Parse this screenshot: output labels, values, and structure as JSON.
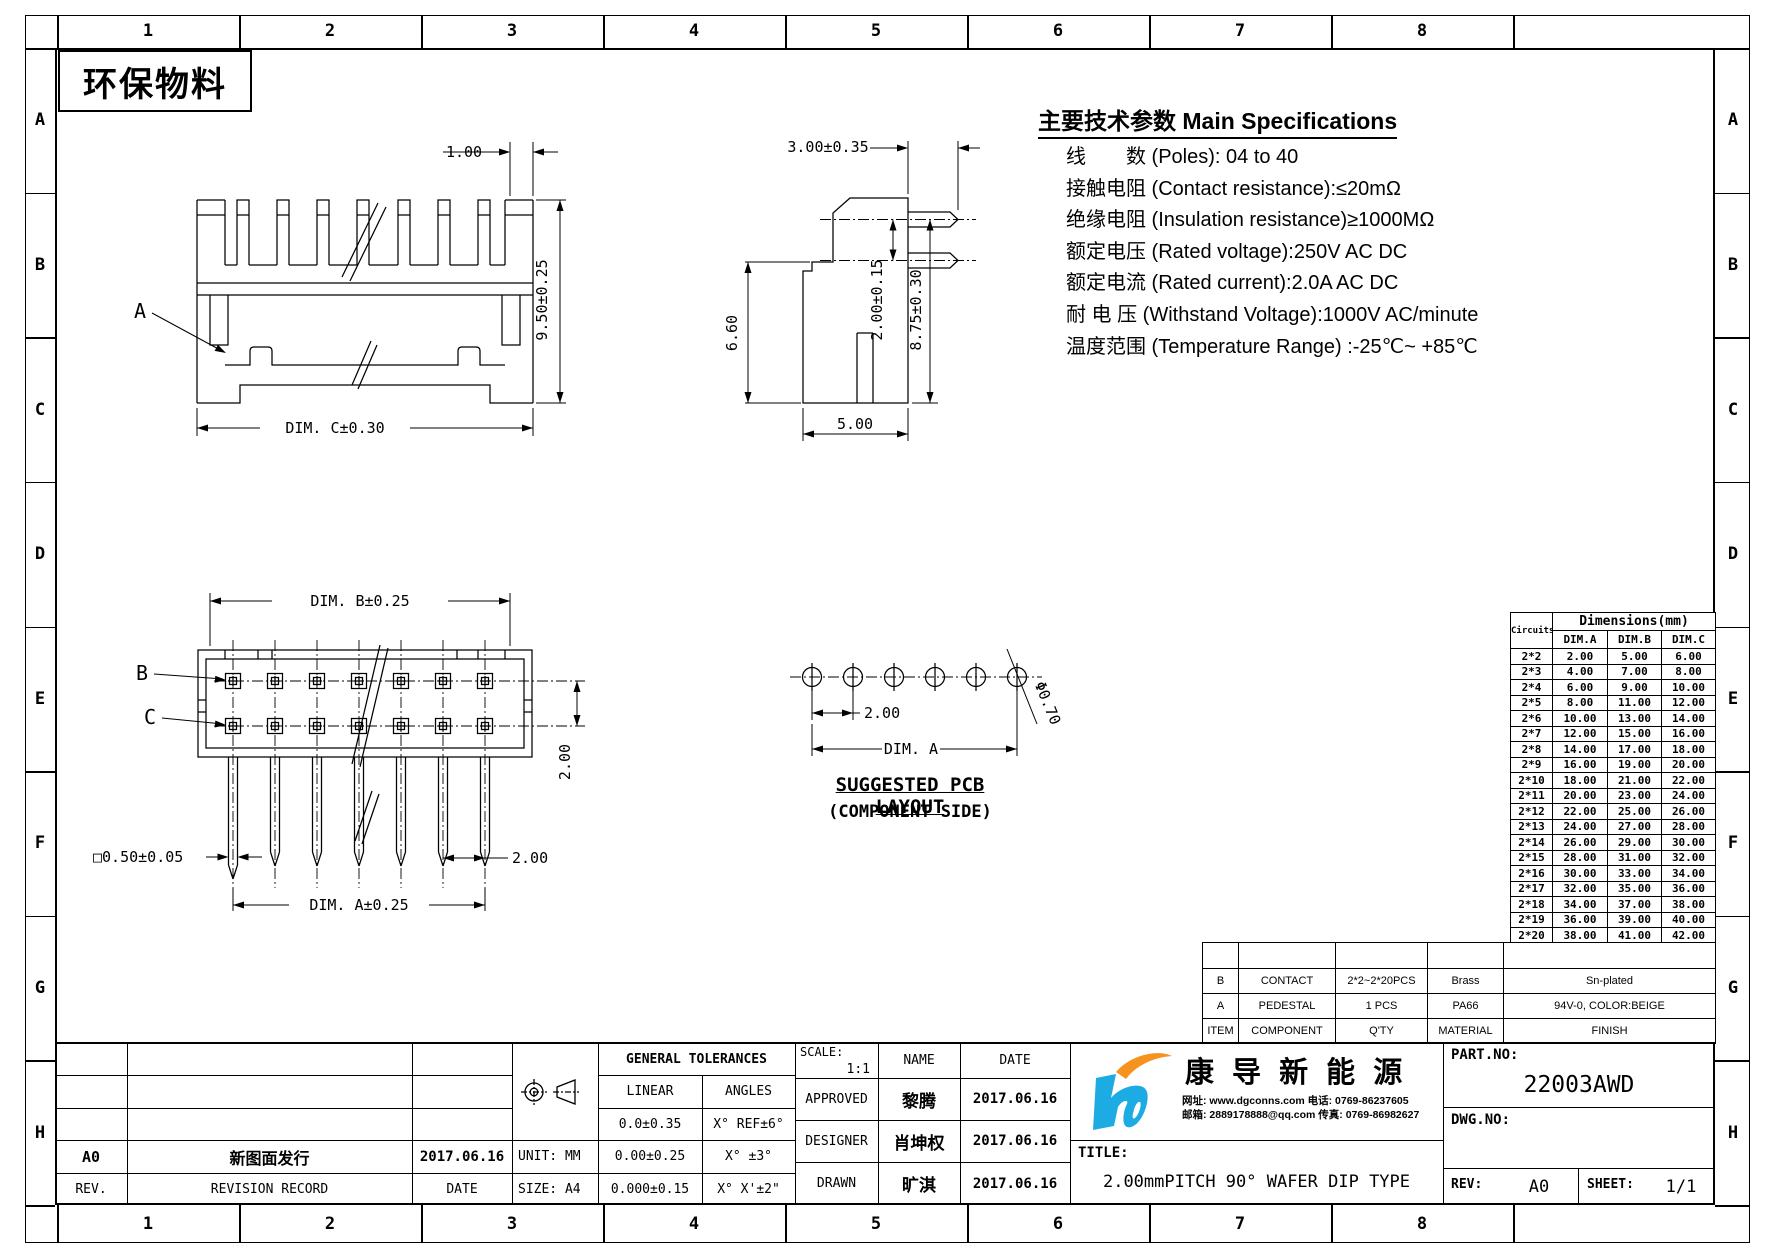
{
  "sheet": {
    "eco_label": "环保物料",
    "zone_columns": [
      "1",
      "2",
      "3",
      "4",
      "5",
      "6",
      "7",
      "8"
    ],
    "zone_rows": [
      "A",
      "B",
      "C",
      "D",
      "E",
      "F",
      "G",
      "H"
    ]
  },
  "specs": {
    "title": "主要技术参数 Main Specifications",
    "lines": [
      "线　　数 (Poles): 04 to 40",
      "接触电阻 (Contact resistance):≤20mΩ",
      "绝缘电阻 (Insulation resistance)≥1000MΩ",
      "额定电压 (Rated voltage):250V AC DC",
      "额定电流 (Rated current):2.0A AC DC",
      "耐 电 压 (Withstand Voltage):1000V AC/minute",
      "温度范围 (Temperature Range) :-25℃~ +85℃"
    ]
  },
  "views": {
    "front_view": {
      "label_a": "A",
      "dim_tooth": "1.00",
      "dim_height": "9.50±0.25",
      "dim_width": "DIM. C±0.30"
    },
    "side_view": {
      "dim_top": "3.00±0.35",
      "dim_front_height": "6.60",
      "dim_bottom": "5.00",
      "dim_pin_spacing": "2.00±0.15",
      "dim_pin_height": "8.75±0.30"
    },
    "top_view": {
      "label_b": "B",
      "label_c": "C",
      "dim_width": "DIM. B±0.25",
      "dim_row_pitch": "2.00",
      "dim_pin_square": "□0.50±0.05",
      "dim_pitch": "2.00",
      "dim_span": "DIM. A±0.25"
    },
    "pcb_layout": {
      "dim_pitch": "2.00",
      "dim_span": "DIM. A",
      "dim_hole": "Φ0.70",
      "title": "SUG GESTED PCB LAYOUT",
      "title_text": "SUGGESTED PCB LAYOUT",
      "subtitle": "(COMPONENT SIDE)"
    }
  },
  "dim_table": {
    "circuits_label": "Circuits",
    "group_header": "Dimensions(mm)",
    "columns": [
      "DIM.A",
      "DIM.B",
      "DIM.C"
    ],
    "rows": [
      [
        "2*2",
        "2.00",
        "5.00",
        "6.00"
      ],
      [
        "2*3",
        "4.00",
        "7.00",
        "8.00"
      ],
      [
        "2*4",
        "6.00",
        "9.00",
        "10.00"
      ],
      [
        "2*5",
        "8.00",
        "11.00",
        "12.00"
      ],
      [
        "2*6",
        "10.00",
        "13.00",
        "14.00"
      ],
      [
        "2*7",
        "12.00",
        "15.00",
        "16.00"
      ],
      [
        "2*8",
        "14.00",
        "17.00",
        "18.00"
      ],
      [
        "2*9",
        "16.00",
        "19.00",
        "20.00"
      ],
      [
        "2*10",
        "18.00",
        "21.00",
        "22.00"
      ],
      [
        "2*11",
        "20.00",
        "23.00",
        "24.00"
      ],
      [
        "2*12",
        "22.00",
        "25.00",
        "26.00"
      ],
      [
        "2*13",
        "24.00",
        "27.00",
        "28.00"
      ],
      [
        "2*14",
        "26.00",
        "29.00",
        "30.00"
      ],
      [
        "2*15",
        "28.00",
        "31.00",
        "32.00"
      ],
      [
        "2*16",
        "30.00",
        "33.00",
        "34.00"
      ],
      [
        "2*17",
        "32.00",
        "35.00",
        "36.00"
      ],
      [
        "2*18",
        "34.00",
        "37.00",
        "38.00"
      ],
      [
        "2*19",
        "36.00",
        "39.00",
        "40.00"
      ],
      [
        "2*20",
        "38.00",
        "41.00",
        "42.00"
      ]
    ]
  },
  "parts_table": {
    "rows": [
      {
        "item": "B",
        "component": "CONTACT",
        "qty": "2*2~2*20PCS",
        "material": "Brass",
        "finish": "Sn-plated"
      },
      {
        "item": "A",
        "component": "PEDESTAL",
        "qty": "1 PCS",
        "material": "PA66",
        "finish": "94V-0, COLOR:BEIGE"
      },
      {
        "item": "ITEM",
        "component": "COMPONENT",
        "qty": "Q'TY",
        "material": "MATERIAL",
        "finish": "FINISH"
      }
    ]
  },
  "title_block": {
    "revision": {
      "rev_value": "A0",
      "record_value": "新图面发行",
      "date_value": "2017.06.16",
      "rev_label": "REV.",
      "record_label": "REVISION RECORD",
      "date_label": "DATE"
    },
    "unit_label": "UNIT: MM",
    "size_label": "SIZE: A4",
    "tolerances": {
      "title": "GENERAL TOLERANCES",
      "linear_label": "LINEAR",
      "angles_label": "ANGLES",
      "rows": [
        {
          "linear": "0.0±0.35",
          "angles": "X° REF±6°"
        },
        {
          "linear": "0.00±0.25",
          "angles": "X° ±3°"
        },
        {
          "linear": "0.000±0.15",
          "angles": "X° X'±2\""
        }
      ]
    },
    "scale_label": "SCALE:",
    "scale_value": "1:1",
    "name_header": "NAME",
    "date_header": "DATE",
    "signers": [
      {
        "role": "APPROVED",
        "name": "黎腾",
        "date": "2017.06.16"
      },
      {
        "role": "DESIGNER",
        "name": "肖坤权",
        "date": "2017.06.16"
      },
      {
        "role": "DRAWN",
        "name": "旷淇",
        "date": "2017.06.16"
      }
    ],
    "company_name": "康 导 新 能 源",
    "contact_line1": "网址: www.dgconns.com  电话: 0769-86237605",
    "contact_line2": "邮箱: 2889178888@qq.com 传真: 0769-86982627",
    "title_label": "TITLE:",
    "drawing_title": "2.00mmPITCH 90° WAFER DIP TYPE",
    "part_no_label": "PART.NO:",
    "part_no_value": "22003AWD",
    "dwg_no_label": "DWG.NO:",
    "rev_label": "REV:",
    "rev_value": "A0",
    "sheet_label": "SHEET:",
    "sheet_value": "1/1"
  }
}
